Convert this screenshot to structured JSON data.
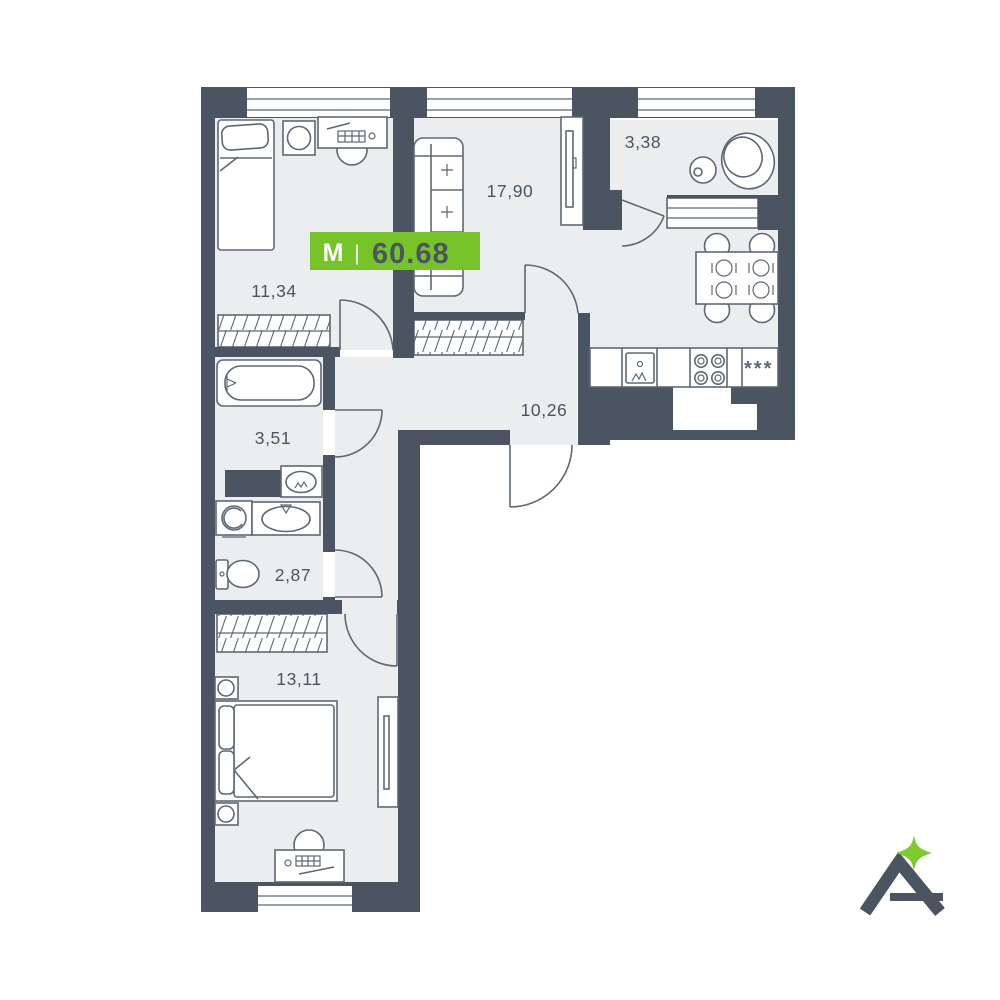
{
  "badge": {
    "type_label": "М",
    "divider": "|",
    "total_area": "60.68"
  },
  "rooms": [
    {
      "name": "bedroom-1",
      "area": "11,34"
    },
    {
      "name": "living-kitchen",
      "area": "17,90"
    },
    {
      "name": "bathroom-top",
      "area": "3,38"
    },
    {
      "name": "hallway",
      "area": "10,26"
    },
    {
      "name": "bathroom",
      "area": "3,51"
    },
    {
      "name": "toilet-room",
      "area": "2,87"
    },
    {
      "name": "bedroom-2",
      "area": "13,11"
    }
  ],
  "kitchen": {
    "fridge_label": "***"
  },
  "logo": {
    "letter": "A",
    "sparkle": "four-point-star"
  },
  "colors": {
    "wall": "#4B5561",
    "floor": "#ECEDEF",
    "line": "#5E6874",
    "text": "#4A5562",
    "badge_green": "#77C42A",
    "star_green": "#7ECB2D"
  }
}
